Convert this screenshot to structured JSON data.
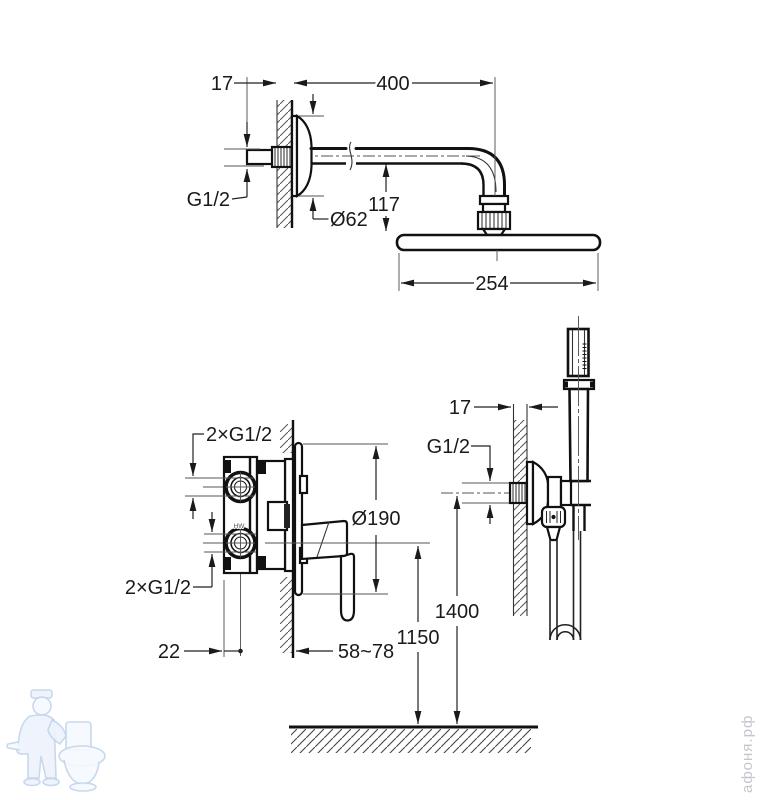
{
  "page": {
    "background": "#ffffff"
  },
  "drawings": {
    "overhead": {
      "title": "overhead-shower-arm-and-head",
      "dims": {
        "wall_offset": "17",
        "arm_length": "400",
        "thread": "G1/2",
        "escutcheon_dia": "Ø62",
        "drop_height": "117",
        "head_width": "254"
      }
    },
    "mixer": {
      "title": "concealed-mixer-valve",
      "dims": {
        "top_ports": "2×G1/2",
        "bottom_ports": "2×G1/2",
        "escutcheon_dia": "Ø190",
        "body_offset": "22",
        "depth_range": "58~78",
        "mount_height": "1150",
        "port_mark": "HW"
      }
    },
    "handshower": {
      "title": "hand-shower-with-wall-holder",
      "dims": {
        "wall_offset": "17",
        "thread": "G1/2",
        "mount_height": "1400"
      }
    }
  },
  "watermark": {
    "brand": "афоня.рф"
  }
}
